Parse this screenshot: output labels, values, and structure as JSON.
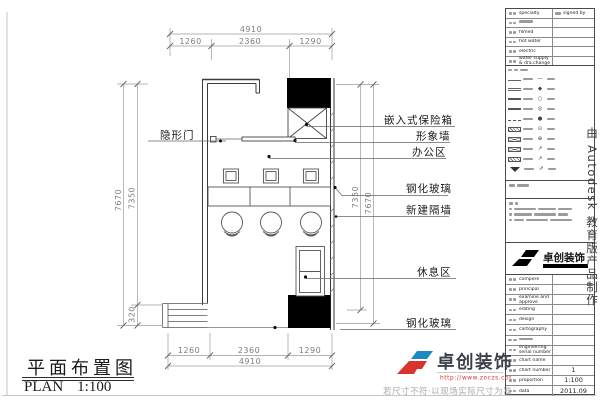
{
  "colors": {
    "accent_red": "#d8332e",
    "accent_blue": "#1a8ac2",
    "wall": "#3a3a3a",
    "dim_gray": "#999999"
  },
  "plan": {
    "title_zh": "平面布置图",
    "title_en": "PLAN",
    "scale": "1:100",
    "dims": {
      "total_width": "4910",
      "seg_left": "1260",
      "seg_mid": "2360",
      "seg_right": "1290",
      "bottom_total": "4910",
      "bottom_seg_left": "1260",
      "bottom_seg_mid": "2360",
      "bottom_seg_right": "1290",
      "left_outer": "7670",
      "left_inner": "7350",
      "left_step": "320",
      "right_inner": "7350",
      "right_outer": "7670"
    },
    "labels": {
      "hidden_door": "隐形门",
      "safe": "嵌入式保险箱",
      "image_wall": "形象墙",
      "office_area": "办公区",
      "tempered_glass_top": "钢化玻璃",
      "new_partition": "新建隔墙",
      "rest_area": "休息区",
      "tempered_glass_bottom": "钢化玻璃"
    }
  },
  "titleblock": {
    "sign_table": {
      "rows": [
        {
          "label": "specialty",
          "right": "signed by"
        },
        {
          "label": "",
          "right": ""
        },
        {
          "label": "filmed",
          "right": ""
        },
        {
          "label": "hot water",
          "right": ""
        },
        {
          "label": "electric",
          "right": ""
        },
        {
          "label": "water supply & dra.change",
          "right": ""
        }
      ]
    },
    "legend": {
      "symbols": [
        "—",
        "◆",
        "○",
        "◎",
        "●",
        "⊙",
        "⊕",
        "↗",
        "↗",
        "⇗"
      ]
    },
    "brand": {
      "name": "卓创装饰"
    },
    "info_table": {
      "rows": [
        {
          "label": "compere",
          "value": ""
        },
        {
          "label": "principal",
          "value": ""
        },
        {
          "label": "examine and approve",
          "value": ""
        },
        {
          "label": "editing",
          "value": ""
        },
        {
          "label": "design",
          "value": ""
        },
        {
          "label": "cartography",
          "value": ""
        },
        {
          "label": "",
          "value": ""
        },
        {
          "label": "engineering serial number",
          "value": ""
        },
        {
          "label": "chart name",
          "value": ""
        },
        {
          "label": "chart number",
          "value": "1"
        },
        {
          "label": "proportion",
          "value": "1:100"
        },
        {
          "label": "data",
          "value": "2011.09"
        }
      ]
    }
  },
  "watermark": {
    "text": "由 Autodesk 教育版产品制作"
  },
  "footer": {
    "brand": "卓创装饰",
    "url": "http://www.zoczs.com",
    "disclaimer": "若尺寸不符·以现场实际尺寸为准"
  }
}
